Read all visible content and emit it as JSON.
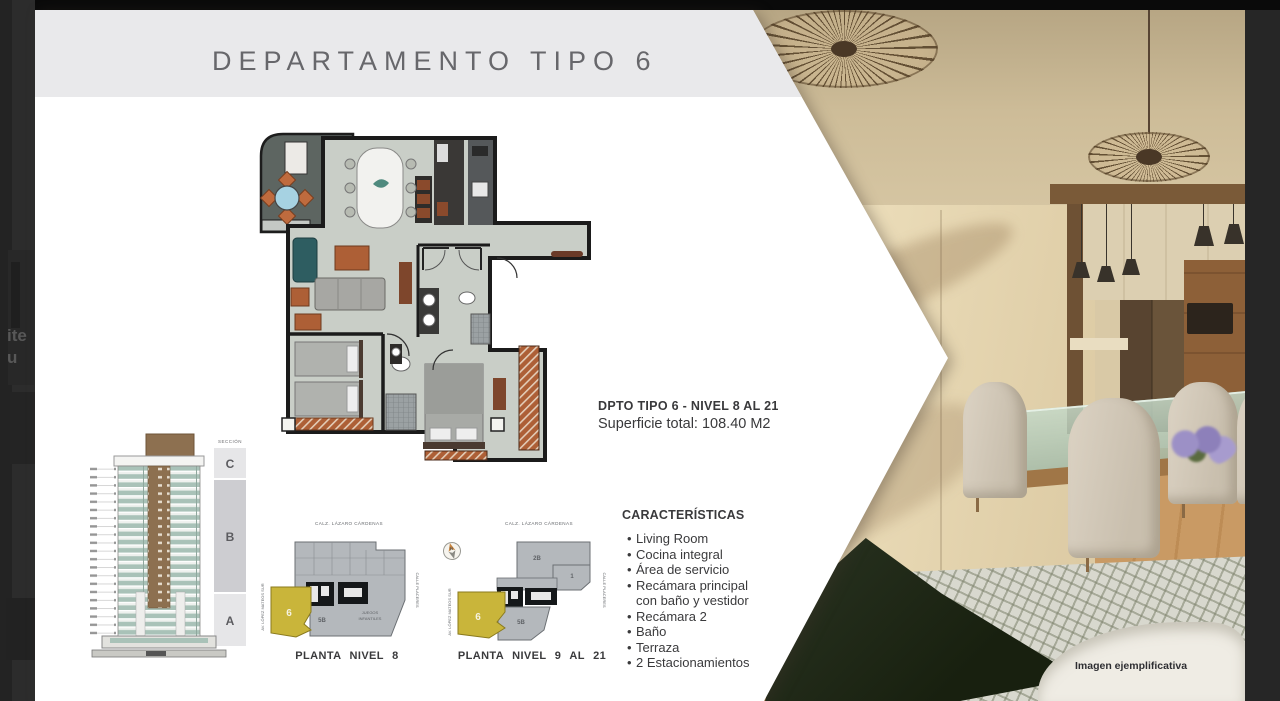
{
  "title": "DEPARTAMENTO TIPO 6",
  "plan_info": {
    "line1": "DPTO TIPO 6 - NIVEL 8 AL 21",
    "line2": "Superficie total: 108.40 M2"
  },
  "features": {
    "heading": "CARACTERÍSTICAS",
    "items": [
      "Living Room",
      "Cocina integral",
      "Área de servicio",
      "Recámara principal con baño y vestidor",
      "Recámara 2",
      "Baño",
      "Terraza",
      "2 Estacionamientos"
    ]
  },
  "elevation": {
    "heading": "SECCIÓN",
    "sections": [
      "C",
      "B",
      "A"
    ]
  },
  "site_plans": {
    "street_top": "CALZ. LÁZARO CÁRDENAS",
    "street_left": "AV. LÓPEZ MATEOS SUR",
    "street_right": "CALLE PLACERES",
    "compass": "N",
    "plan8": {
      "caption": "PLANTA NIVEL 8",
      "unit": "6",
      "unit_5b": "5B",
      "juegos_line1": "JUEGOS",
      "juegos_line2": "INFANTILES"
    },
    "plan921": {
      "caption": "PLANTA NIVEL 9 AL 21",
      "unit": "6",
      "unit_5b": "5B",
      "unit_2b": "2B",
      "unit_1": "1"
    }
  },
  "photo": {
    "watermark": "Imagen ejemplificativa"
  },
  "left_edge": {
    "fragment1": "ite",
    "fragment2": "u"
  }
}
